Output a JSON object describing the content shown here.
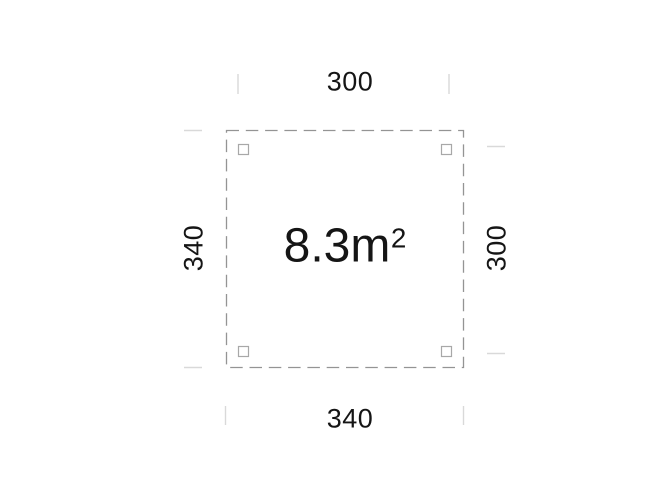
{
  "plan": {
    "dimensions": {
      "top": "300",
      "bottom": "340",
      "left": "340",
      "right": "300"
    },
    "area": {
      "value": "8.3m",
      "sup": "2"
    },
    "colors": {
      "background": "#ffffff",
      "outline": "#949494",
      "post": "#a8a8a8",
      "tick": "#d9d9d9",
      "text": "#151515"
    }
  }
}
